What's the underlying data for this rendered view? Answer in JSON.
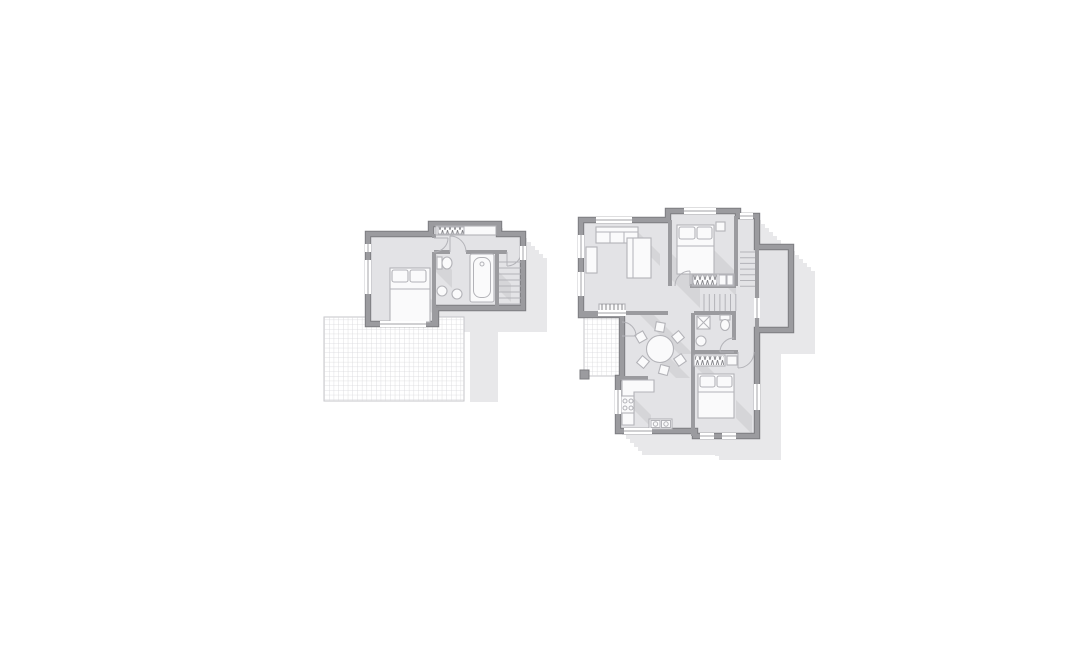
{
  "palette": {
    "bg": "#ffffff",
    "wall": "#9b9b9f",
    "wallEdge": "#7c7c80",
    "floor": "#e3e3e6",
    "shadow": "#e8e8ea",
    "line": "#b3b3b8",
    "lineDark": "#85858a",
    "furnFill": "#fafafb",
    "grid": "#d7d7da",
    "gridEdge": "#c5c5c9",
    "innerShadow": "rgba(125,125,133,0.14)"
  },
  "diagram": {
    "type": "architectural-floor-plans-top-down",
    "background_color": "#ffffff",
    "plans": [
      {
        "name": "upper-floor-plan",
        "position": "left",
        "rooms": [
          "bedroom",
          "bathroom",
          "hallway",
          "staircase"
        ],
        "features": [
          "double-bed-with-two-pillows",
          "built-in-wardrobe-hatched",
          "bathtub",
          "toilet",
          "two-washbasins",
          "door-swing-arcs",
          "windows",
          "large-tiled-roof-terrace-grid",
          "cast-drop-shadow"
        ]
      },
      {
        "name": "ground-floor-plan",
        "position": "right",
        "rooms": [
          "living-room",
          "bedroom-north",
          "bedroom-south",
          "kitchen",
          "dining-area",
          "bathroom",
          "hallway",
          "staircase",
          "balcony",
          "patio"
        ],
        "features": [
          "sofa",
          "side-table",
          "long-table",
          "radiator",
          "two-double-beds",
          "hatched-wardrobes",
          "round-dining-table-with-six-chairs",
          "l-shaped-kitchen-counter",
          "four-burner-stove",
          "double-basin-sink",
          "shower",
          "toilet",
          "washbasin",
          "l-shaped-staircase",
          "small-tiled-patio-with-pillar",
          "door-swing-arcs",
          "windows",
          "cast-drop-shadow"
        ]
      }
    ]
  }
}
